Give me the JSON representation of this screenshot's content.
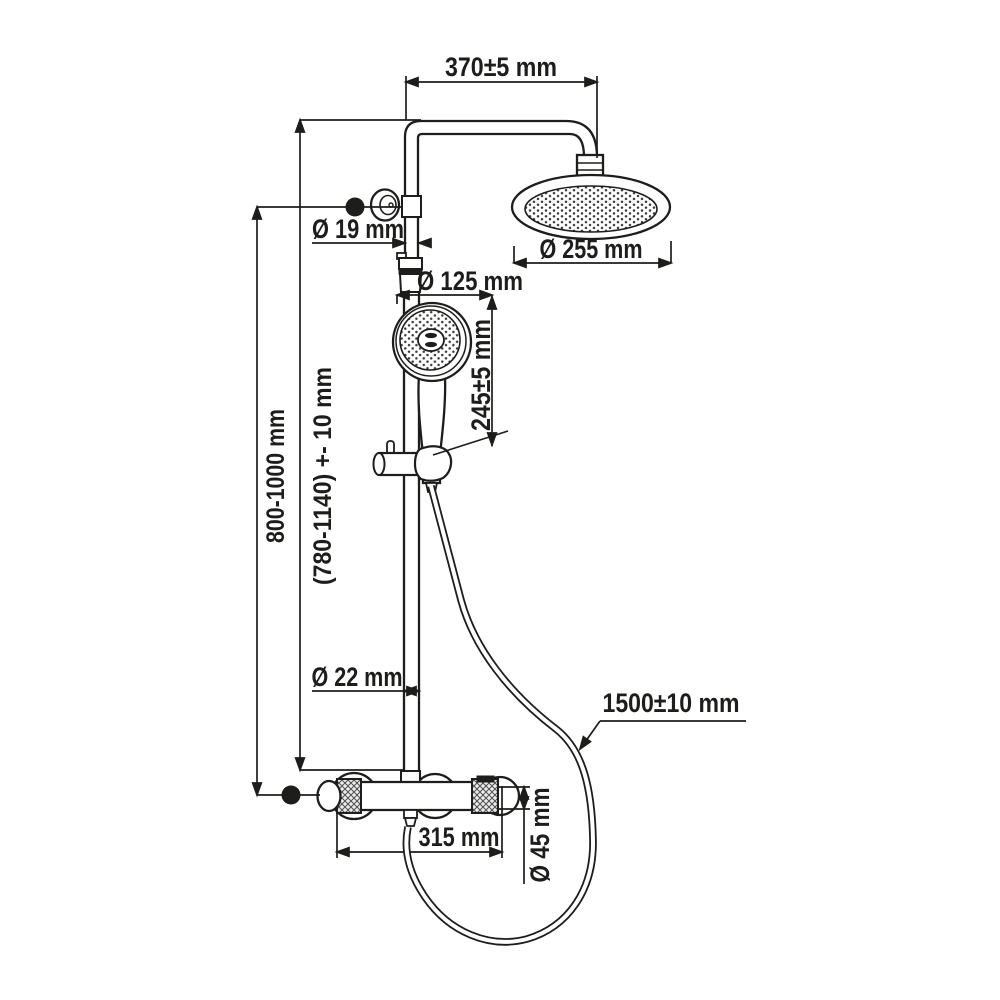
{
  "page": {
    "background": "#ffffff",
    "line_color": "#1d1d1b"
  },
  "drawing": {
    "kind": "shower-system-installation-drawing",
    "units": "mm",
    "labels": {
      "arm_projection": "370±5 mm",
      "wall_supply_diameter": "Ø 19 mm",
      "rain_head_diameter": "Ø 255 mm",
      "hand_shower_diameter": "Ø 125 mm",
      "hand_shower_length": "245±5 mm",
      "bracket_height_range": "800-1000 mm",
      "adjustable_height_range": "(780-1140) +- 10 mm",
      "rail_diameter": "Ø 22 mm",
      "hose_length": "1500±10 mm",
      "mixer_width": "315 mm",
      "mixer_body_diameter": "Ø 45 mm"
    }
  }
}
